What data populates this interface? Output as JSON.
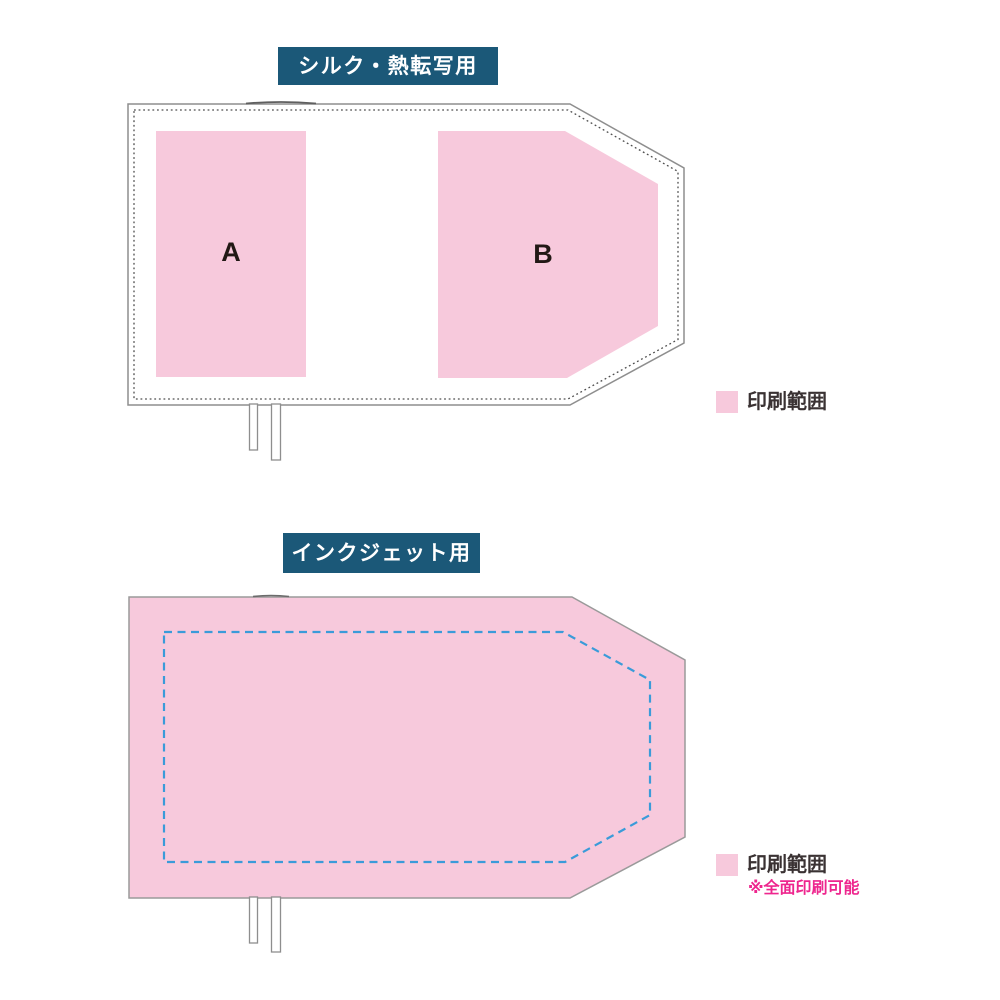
{
  "sections": {
    "silk": {
      "title": "シルク・熱転写用",
      "area_a_label": "A",
      "area_b_label": "B",
      "legend": {
        "label": "印刷範囲"
      }
    },
    "inkjet": {
      "title": "インクジェット用",
      "legend": {
        "label": "印刷範囲",
        "note": "※全面印刷可能"
      }
    }
  },
  "colors": {
    "title_bg_teal": "#1B5878",
    "title_text_white": "#FFFFFF",
    "print_area_pink": "#F7C9DC",
    "product_outline_gray": "#8E8E8E",
    "stitch_dotted_gray": "#4D4D4D",
    "inkjet_dash_blue": "#3A9BD9",
    "legend_text_dark": "#3A3233",
    "note_magenta": "#EE268E",
    "area_label_black": "#221815"
  }
}
